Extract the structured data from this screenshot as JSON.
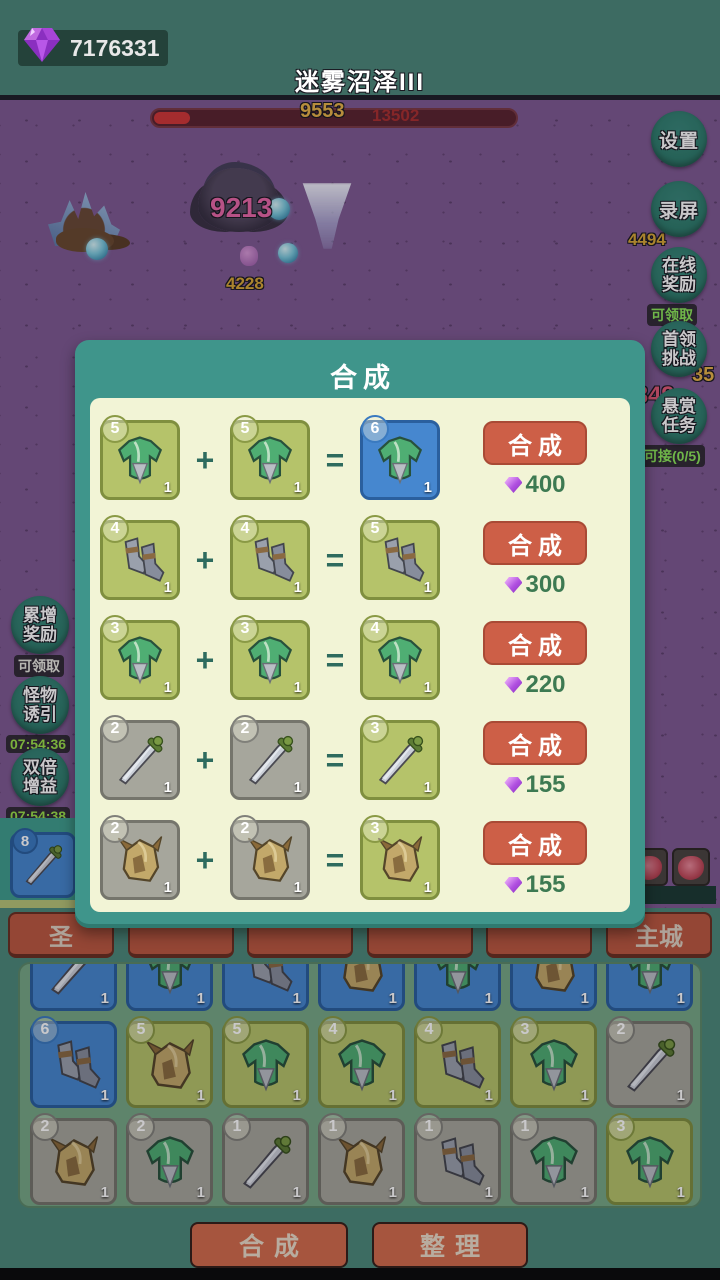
{
  "topbar": {
    "gem_count": "7176331",
    "title": "迷雾沼泽III"
  },
  "battle": {
    "hp_current": "9553",
    "hp_total": "13502",
    "damage_numbers": [
      {
        "text": "9213",
        "x": 210,
        "y": 92,
        "color": "#e868a8",
        "size": 28
      },
      {
        "text": "4228",
        "x": 226,
        "y": 174,
        "color": "#d8a838",
        "size": 17
      },
      {
        "text": "4494",
        "x": 628,
        "y": 130,
        "color": "#d8a838",
        "size": 17
      },
      {
        "text": "35",
        "x": 692,
        "y": 264,
        "color": "#e8b44a",
        "size": 20
      },
      {
        "text": "10849",
        "x": 608,
        "y": 282,
        "color": "#e05a78",
        "size": 24
      }
    ]
  },
  "right_buttons": [
    {
      "label": "设置",
      "sub": ""
    },
    {
      "label": "录屏",
      "sub": ""
    },
    {
      "label": "在线\n奖励",
      "sub": "可领取",
      "sub_color": "#8ce85a"
    },
    {
      "label": "首领\n挑战",
      "sub": ""
    },
    {
      "label": "悬赏\n任务",
      "sub": "可接(0/5)",
      "sub_color": "#8ce85a"
    }
  ],
  "left_buttons": [
    {
      "label": "累增\n奖励",
      "sub": "可领取",
      "sub_color": "#e8e8e0"
    },
    {
      "label": "怪物\n诱引",
      "sub": "07:54:36",
      "sub_color": "#9ae04a"
    },
    {
      "label": "双倍\n增益",
      "sub": "07:54:38",
      "sub_color": "#9ae04a"
    }
  ],
  "equip_slot": {
    "type": "sword",
    "level": "8",
    "tier": "blue"
  },
  "modal": {
    "title": "合成",
    "plus": "+",
    "equals": "=",
    "craft_label": "合成",
    "rows": [
      {
        "type": "armor",
        "in_level": "5",
        "in_tier": "olive",
        "out_level": "6",
        "out_tier": "blue",
        "qty": "1",
        "cost": "400"
      },
      {
        "type": "boots",
        "in_level": "4",
        "in_tier": "olive",
        "out_level": "5",
        "out_tier": "olive",
        "qty": "1",
        "cost": "300"
      },
      {
        "type": "armor",
        "in_level": "3",
        "in_tier": "olive",
        "out_level": "4",
        "out_tier": "olive",
        "qty": "1",
        "cost": "220"
      },
      {
        "type": "sword",
        "in_level": "2",
        "in_tier": "gray",
        "out_level": "3",
        "out_tier": "olive",
        "qty": "1",
        "cost": "155"
      },
      {
        "type": "helmet",
        "in_level": "2",
        "in_tier": "gray",
        "out_level": "3",
        "out_tier": "olive",
        "qty": "1",
        "cost": "155"
      }
    ]
  },
  "tabs": [
    {
      "label": "圣"
    },
    {
      "label": ""
    },
    {
      "label": ""
    },
    {
      "label": ""
    },
    {
      "label": ""
    },
    {
      "label": "主城"
    }
  ],
  "inventory": {
    "rows": [
      [
        {
          "type": "sword",
          "level": "",
          "tier": "blue",
          "qty": "1"
        },
        {
          "type": "armor",
          "level": "",
          "tier": "blue",
          "qty": "1"
        },
        {
          "type": "boots",
          "level": "",
          "tier": "blue",
          "qty": "1"
        },
        {
          "type": "helmet",
          "level": "",
          "tier": "blue",
          "qty": "1"
        },
        {
          "type": "armor",
          "level": "",
          "tier": "blue",
          "qty": "1"
        },
        {
          "type": "helmet",
          "level": "",
          "tier": "blue",
          "qty": "1"
        },
        {
          "type": "armor",
          "level": "",
          "tier": "blue",
          "qty": "1"
        }
      ],
      [
        {
          "type": "boots",
          "level": "6",
          "tier": "blue",
          "qty": "1"
        },
        {
          "type": "helmet",
          "level": "5",
          "tier": "olive",
          "qty": "1"
        },
        {
          "type": "armor",
          "level": "5",
          "tier": "olive",
          "qty": "1"
        },
        {
          "type": "armor",
          "level": "4",
          "tier": "olive",
          "qty": "1"
        },
        {
          "type": "boots",
          "level": "4",
          "tier": "olive",
          "qty": "1"
        },
        {
          "type": "armor",
          "level": "3",
          "tier": "olive",
          "qty": "1"
        },
        {
          "type": "sword",
          "level": "2",
          "tier": "gray",
          "qty": "1"
        }
      ],
      [
        {
          "type": "helmet",
          "level": "2",
          "tier": "gray",
          "qty": "1"
        },
        {
          "type": "armor",
          "level": "2",
          "tier": "gray",
          "qty": "1"
        },
        {
          "type": "sword",
          "level": "1",
          "tier": "gray",
          "qty": "1"
        },
        {
          "type": "helmet",
          "level": "1",
          "tier": "gray",
          "qty": "1"
        },
        {
          "type": "boots",
          "level": "1",
          "tier": "gray",
          "qty": "1"
        },
        {
          "type": "armor",
          "level": "1",
          "tier": "gray",
          "qty": "1"
        },
        {
          "type": "armor",
          "level": "3",
          "tier": "olive",
          "qty": "1"
        }
      ]
    ]
  },
  "bottom_buttons": [
    {
      "label": "合成"
    },
    {
      "label": "整理"
    }
  ]
}
